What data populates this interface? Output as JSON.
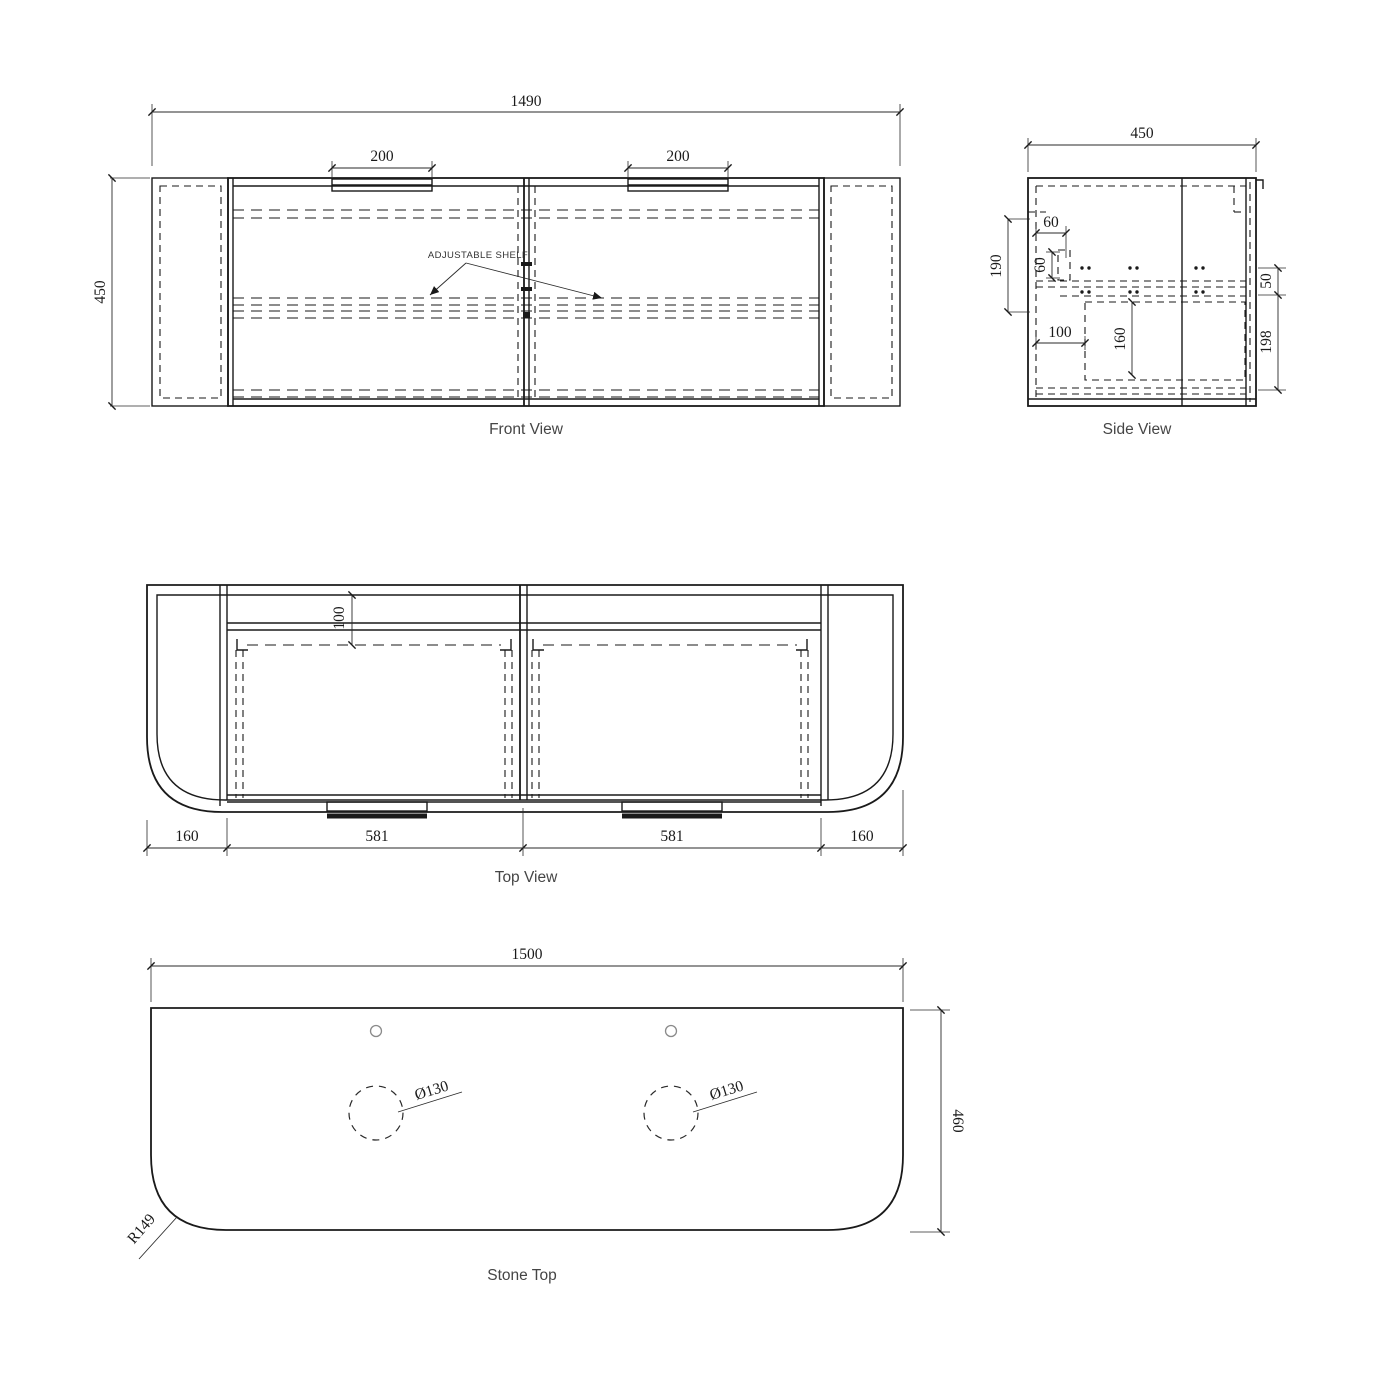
{
  "colors": {
    "line": "#1a1a1a",
    "dim_text": "#1a1a1a",
    "label_text": "#454545",
    "page": "#ffffff"
  },
  "front_view": {
    "title": "Front View",
    "note": "ADJUSTABLE SHELF",
    "dims": {
      "overall_width": "1490",
      "overall_height": "450",
      "handle_left": "200",
      "handle_right": "200"
    }
  },
  "side_view": {
    "title": "Side View",
    "dims": {
      "depth": "450",
      "wall_offset": "190",
      "bracket_width": "60",
      "bracket_height": "60",
      "drawer_offset": "100",
      "drawer_height": "160",
      "top_gap": "50",
      "bottom_gap": "198"
    }
  },
  "top_view": {
    "title": "Top View",
    "dims": {
      "back_gap": "100",
      "left_return": "160",
      "door_left": "581",
      "door_right": "581",
      "right_return": "160"
    }
  },
  "stone_top": {
    "title": "Stone Top",
    "dims": {
      "width": "1500",
      "depth": "460",
      "hole_left": "Ø130",
      "hole_right": "Ø130",
      "corner_radius": "R149"
    }
  }
}
